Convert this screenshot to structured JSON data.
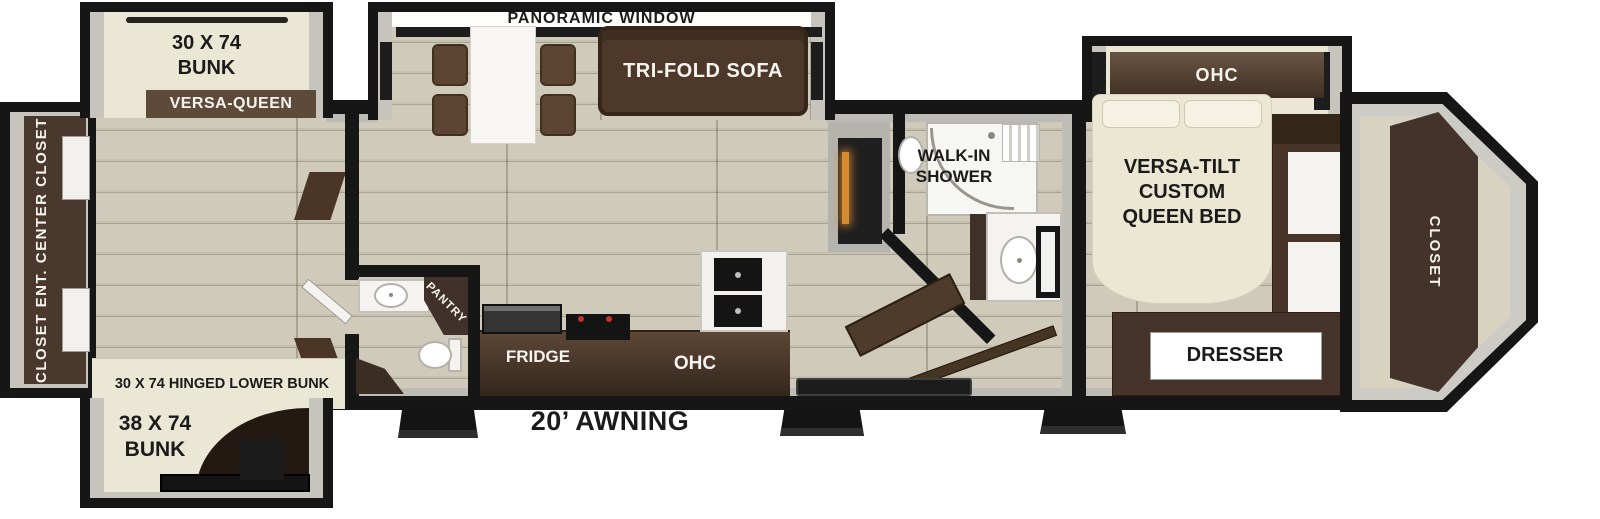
{
  "floorplan": {
    "labels": {
      "panoramic_window": "PANORAMIC WINDOW",
      "bunk_top": "30 X 74\nBUNK",
      "versa_queen": "VERSA-QUEEN",
      "rear_wall": "CLOSET  ENT. CENTER  CLOSET",
      "tri_fold_sofa": "TRI-FOLD SOFA",
      "hinged_lower_bunk": "30 X 74 HINGED LOWER BUNK",
      "bunk_bottom": "38 X 74\nBUNK",
      "pantry": "PANTRY",
      "fridge": "FRIDGE",
      "kitchen_ohc": "OHC",
      "awning": "20’ AWNING",
      "walk_in_shower": "WALK-IN\nSHOWER",
      "bedroom_ohc": "OHC",
      "queen_bed": "VERSA-TILT\nCUSTOM\nQUEEN BED",
      "dresser": "DRESSER",
      "front_closet": "CLOSET"
    },
    "colors": {
      "wall": "#161616",
      "floor_plank": "#cfcab9",
      "floor_line": "#a8a290",
      "cream_furniture": "#ebe7d5",
      "slide_wall_gray": "#c6c4bd",
      "wood_dark": "#40312a",
      "wood_counter": "#5d4736",
      "sofa_brown": "#4e382a",
      "white_surface": "#f4f3ef",
      "fireplace_glow": "#d88a2f",
      "black_fixture": "#141414",
      "stove_burner": "#c2342a"
    }
  }
}
